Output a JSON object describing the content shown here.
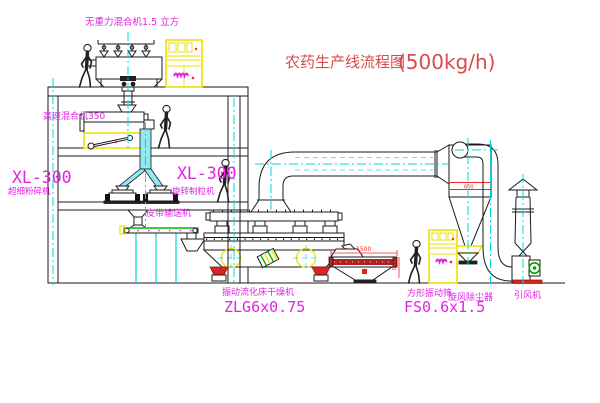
{
  "title": {
    "text": "农药生产线流程图",
    "capacity": "(500kg/h)"
  },
  "labels": {
    "top_mixer": "无重力混合机1.5 立方",
    "high_speed_mixer": "高速混合机350",
    "mill_model": "XL-300",
    "mill_name": "超细粉碎机",
    "granulator_model": "XL-300",
    "granulator_name": "旋转制粒机",
    "belt_conveyor": "皮带输送机",
    "dryer_name": "振动流化床干燥机",
    "dryer_model": "ZLG6x0.75",
    "screen_name": "方形振动筛",
    "screen_model": "FS0.6x1.5",
    "cyclone_name": "旋风除尘器",
    "fan_name": "引风机"
  },
  "dimensions": {
    "screen_length": "1500",
    "screen_height": "340",
    "cyclone_band": "600"
  },
  "colors": {
    "label_magenta": "#e322e3",
    "title_red": "#d94a4a",
    "dim_red": "#ff2222",
    "centerline_cyan": "#00d8e0",
    "pipe_fill": "#90e8f0",
    "cabinet_yellow": "#efe000",
    "conveyor_green": "#00b400",
    "motor_green": "#00a000",
    "screen_red": "#b02020",
    "base_red": "#dd2222",
    "line_black": "#1a1a1a"
  }
}
